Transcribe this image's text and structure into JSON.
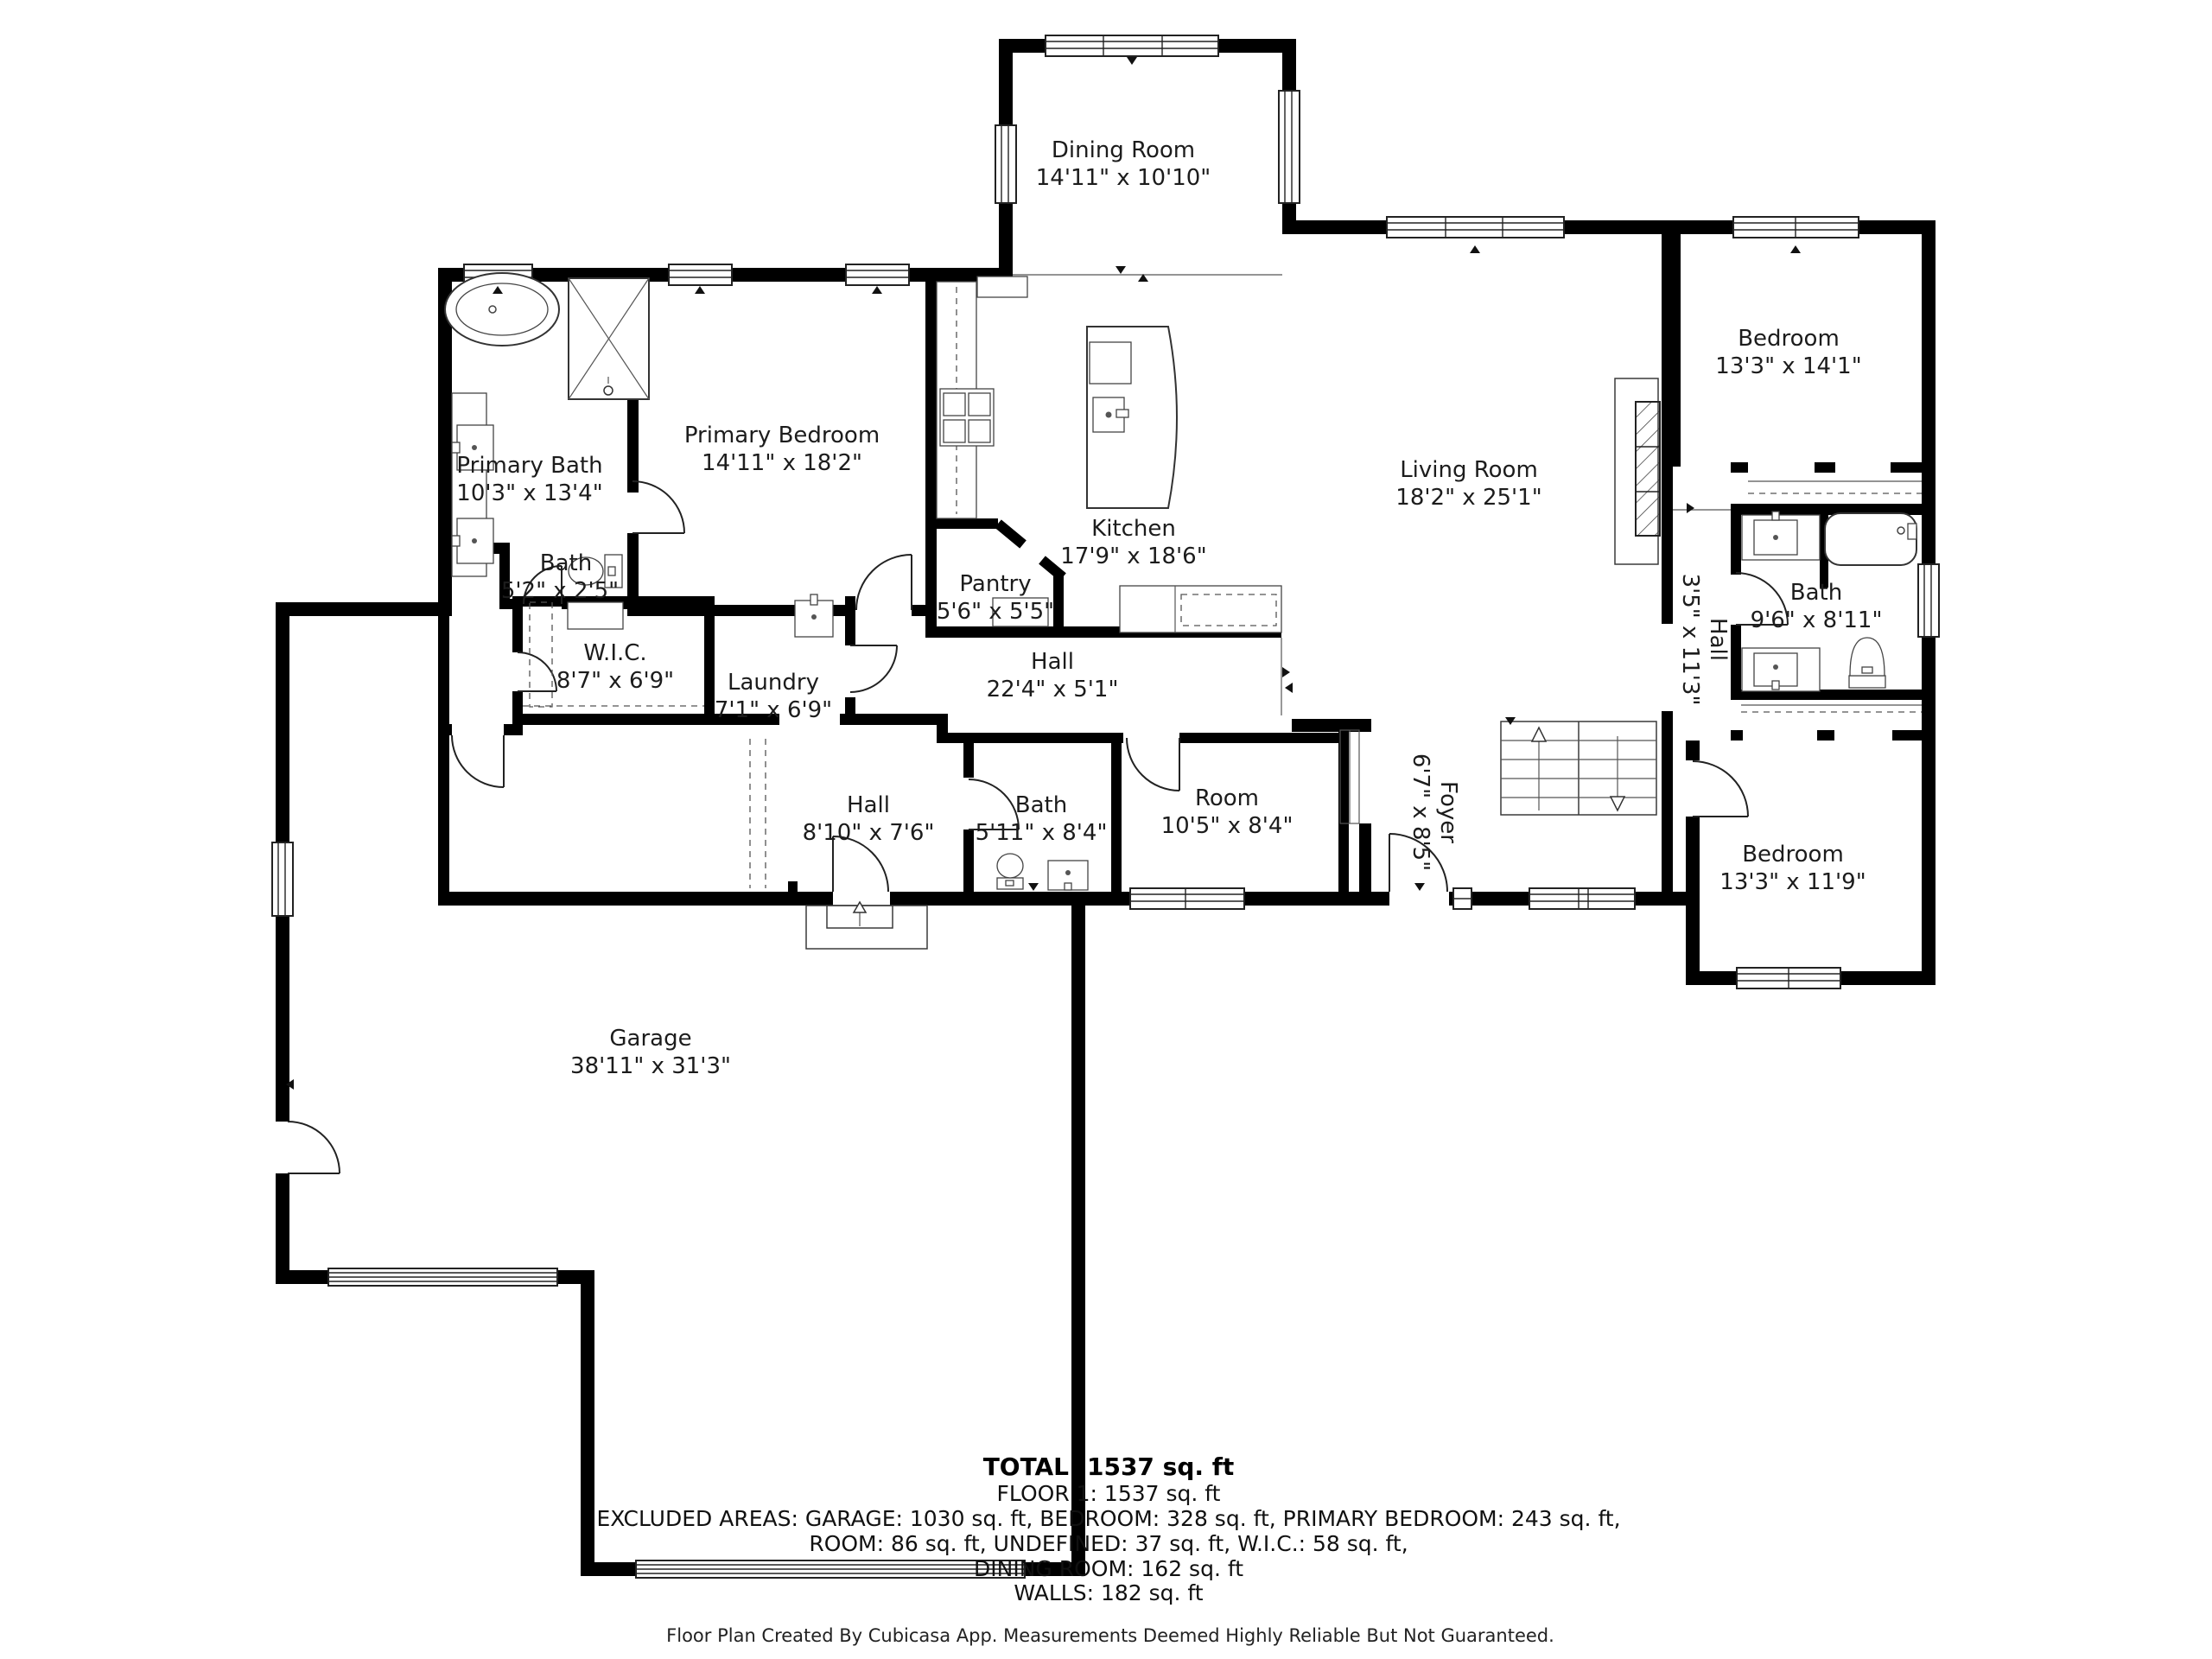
{
  "rooms": {
    "dining": {
      "name": "Dining Room",
      "dims": "14'11\" x 10'10\""
    },
    "primary_bath": {
      "name": "Primary Bath",
      "dims": "10'3\" x 13'4\""
    },
    "primary_bedroom": {
      "name": "Primary Bedroom",
      "dims": "14'11\" x 18'2\""
    },
    "bath_small": {
      "name": "Bath",
      "dims": "5'2\" x 2'5\""
    },
    "wic": {
      "name": "W.I.C.",
      "dims": "8'7\" x 6'9\""
    },
    "laundry": {
      "name": "Laundry",
      "dims": "7'1\" x 6'9\""
    },
    "kitchen": {
      "name": "Kitchen",
      "dims": "17'9\" x 18'6\""
    },
    "pantry": {
      "name": "Pantry",
      "dims": "5'6\" x 5'5\""
    },
    "hall_main": {
      "name": "Hall",
      "dims": "22'4\" x 5'1\""
    },
    "living": {
      "name": "Living Room",
      "dims": "18'2\" x 25'1\""
    },
    "bedroom_ne": {
      "name": "Bedroom",
      "dims": "13'3\" x 14'1\""
    },
    "bath_right": {
      "name": "Bath",
      "dims": "9'6\" x 8'11\""
    },
    "hall_right": {
      "name": "Hall",
      "dims": "3'5\" x 11'3\""
    },
    "foyer": {
      "name": "Foyer",
      "dims": "6'7\" x 8'5\""
    },
    "hall_lower": {
      "name": "Hall",
      "dims": "8'10\" x 7'6\""
    },
    "bath_lower": {
      "name": "Bath",
      "dims": "5'11\" x 8'4\""
    },
    "room": {
      "name": "Room",
      "dims": "10'5\" x 8'4\""
    },
    "bedroom_se": {
      "name": "Bedroom",
      "dims": "13'3\" x 11'9\""
    },
    "garage": {
      "name": "Garage",
      "dims": "38'11\" x 31'3\""
    }
  },
  "summary": {
    "total": "TOTAL: 1537 sq. ft",
    "floor": "FLOOR 1: 1537 sq. ft",
    "excluded1": "EXCLUDED AREAS: GARAGE: 1030 sq. ft, BEDROOM: 328 sq. ft, PRIMARY BEDROOM: 243 sq. ft,",
    "excluded2": "ROOM: 86 sq. ft, UNDEFINED: 37 sq. ft, W.I.C.: 58 sq. ft,",
    "excluded3": "DINING ROOM: 162 sq. ft",
    "walls": "WALLS: 182 sq. ft"
  },
  "footer": "Floor Plan Created By Cubicasa App. Measurements Deemed Highly Reliable But Not Guaranteed.",
  "colors": {
    "wall": "#000000",
    "background": "#ffffff",
    "text": "#1c1c1c"
  }
}
